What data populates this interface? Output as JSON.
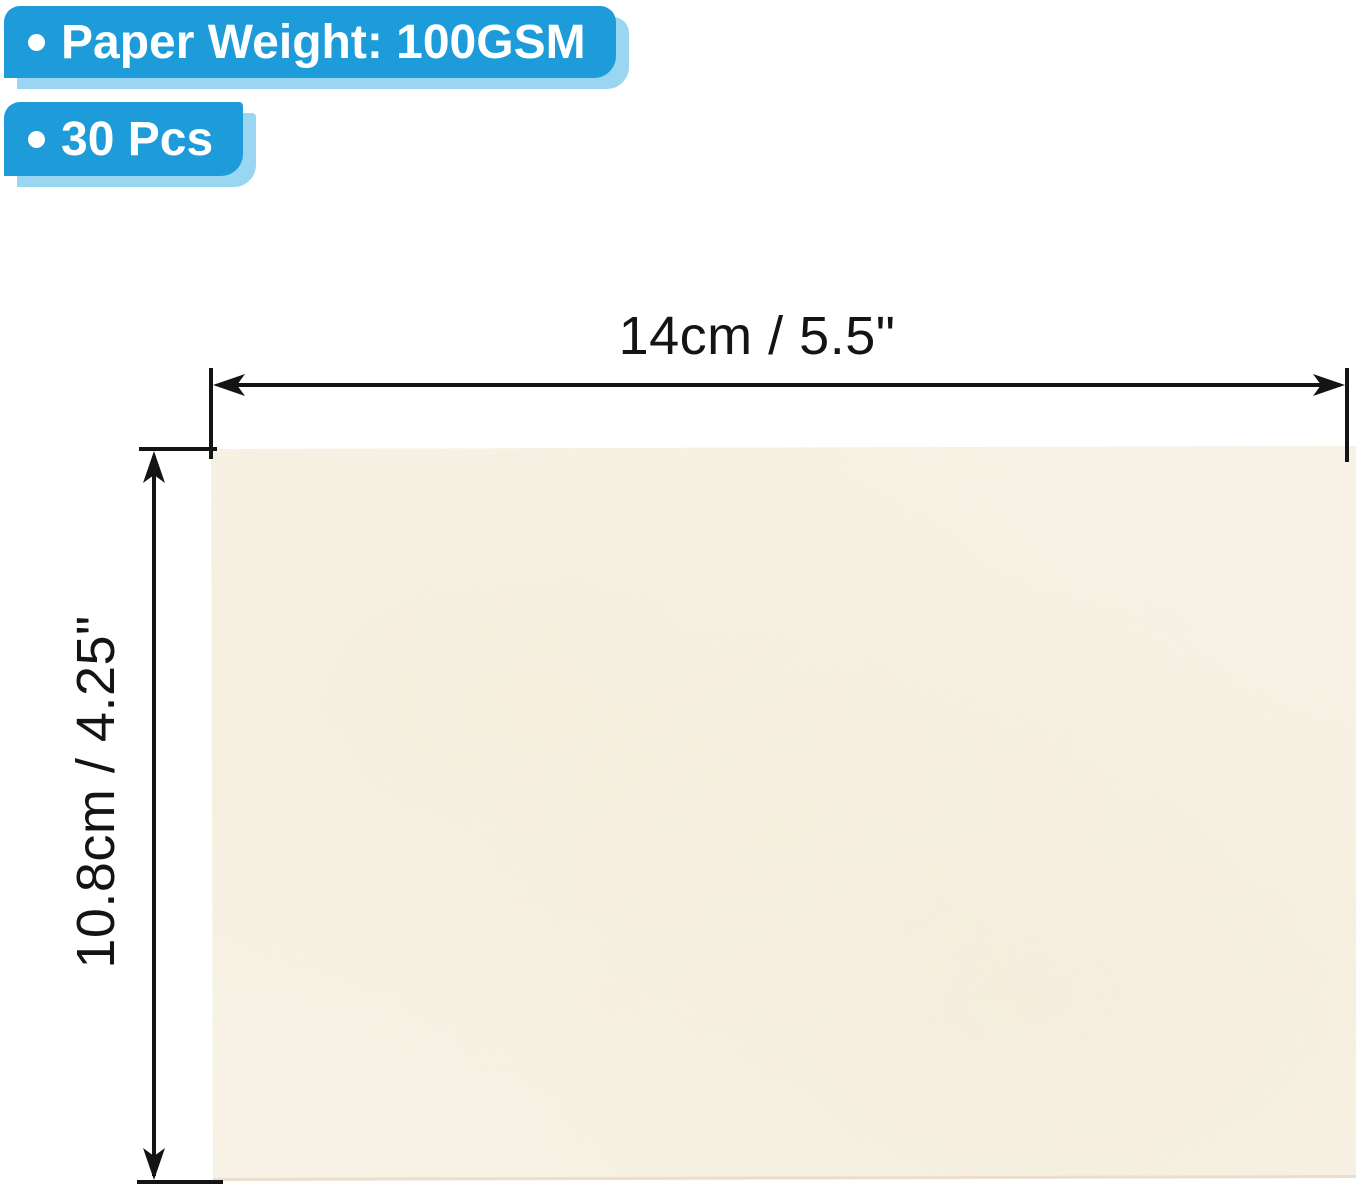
{
  "badges": [
    {
      "bullet": "•",
      "label": "Paper Weight: 100GSM"
    },
    {
      "bullet": "•",
      "label": "30 Pcs"
    }
  ],
  "dimensions": {
    "width_label": "14cm / 5.5\"",
    "height_label": "10.8cm / 4.25\""
  },
  "icons": {
    "bullet": "round-dot",
    "width_arrow": "double-headed-horizontal-arrow",
    "height_arrow": "double-headed-vertical-arrow"
  },
  "colors": {
    "badge-blue": "#1D9CD9",
    "badge-shadow-blue": "#9AD6F2",
    "paper-cream": "#F7F2E5",
    "line-black": "#141414",
    "text-white": "#FFFFFF"
  }
}
